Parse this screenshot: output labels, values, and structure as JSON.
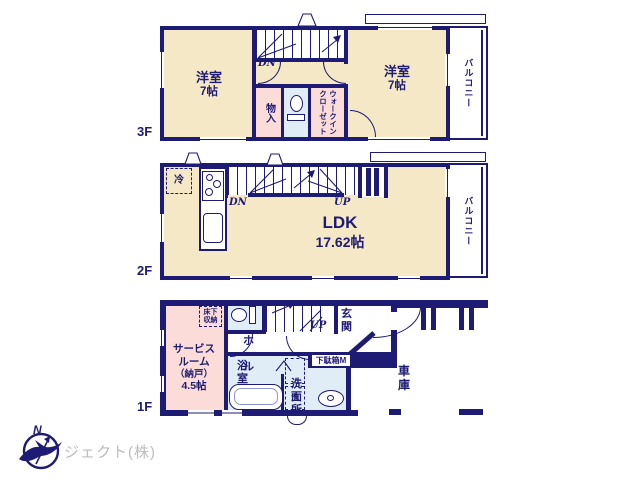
{
  "colors": {
    "wall": "#1e1b74",
    "room_beige": "#f5e8c6",
    "room_pink": "#fbdcd8",
    "room_blue": "#e0edf6",
    "logo_gray": "#bcbcbc"
  },
  "floors": {
    "f3": {
      "label": "3F",
      "room_left_name": "洋室",
      "room_left_size": "7帖",
      "room_right_name": "洋室",
      "room_right_size": "7帖",
      "storage": "物入",
      "wic": "ウォークインクローゼット",
      "balcony": "バルコニー",
      "dn": "DN"
    },
    "f2": {
      "label": "2F",
      "fridge": "冷",
      "dn": "DN",
      "up": "UP",
      "ldk_name": "LDK",
      "ldk_size": "17.62帖",
      "balcony": "バルコニー"
    },
    "f1": {
      "label": "1F",
      "service_l1": "サービス",
      "service_l2": "ルーム",
      "service_l3": "（納戸）",
      "service_l4": "4.5帖",
      "underfloor_l1": "床下",
      "underfloor_l2": "収納",
      "hall": "ホール",
      "bath": "浴室",
      "washroom": "洗面所",
      "washer": "洗",
      "entrance": "玄関",
      "shoebox": "下駄箱M",
      "garage": "車庫",
      "up": "UP"
    }
  },
  "logo": {
    "company": "ジェクト(株)",
    "compass": "N"
  }
}
